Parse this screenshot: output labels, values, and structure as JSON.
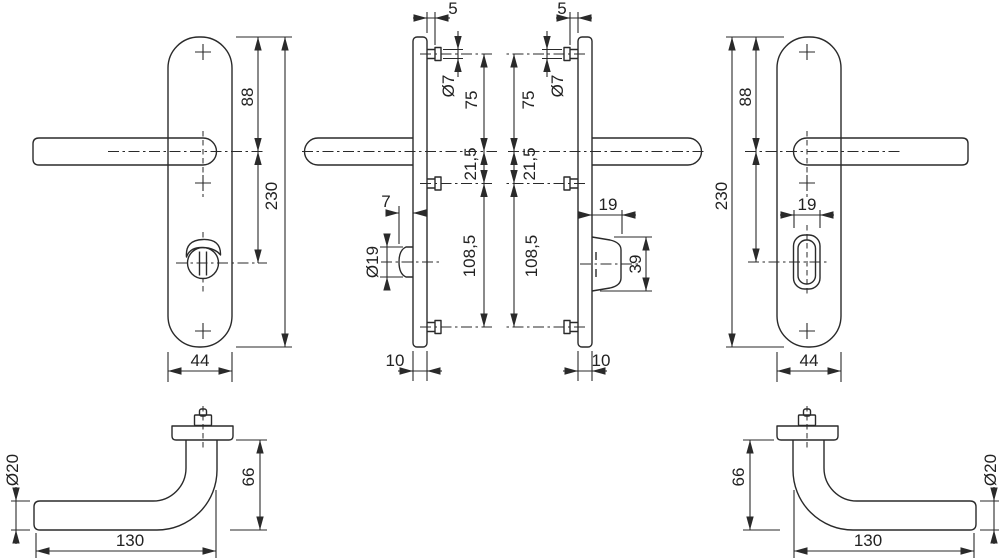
{
  "drawing": {
    "background": "#ffffff",
    "line_color": "#2a2a2a",
    "views": {
      "front_left": {
        "d88": "88",
        "d230": "230",
        "d44": "44"
      },
      "side_left": {
        "d5": "5",
        "dia7": "Ø7",
        "d75": "75",
        "d21_5": "21,5",
        "d108_5": "108,5",
        "d7": "7",
        "dia19": "Ø19",
        "d10": "10"
      },
      "side_right": {
        "d5": "5",
        "dia7": "Ø7",
        "d75": "75",
        "d21_5": "21,5",
        "d108_5": "108,5",
        "d19": "19",
        "d39": "39",
        "d10": "10"
      },
      "front_right": {
        "d88": "88",
        "d230": "230",
        "d19": "19",
        "d44": "44"
      },
      "lever_left": {
        "dia20": "Ø20",
        "d66": "66",
        "d130": "130"
      },
      "lever_right": {
        "dia20": "Ø20",
        "d66": "66",
        "d130": "130"
      }
    }
  }
}
